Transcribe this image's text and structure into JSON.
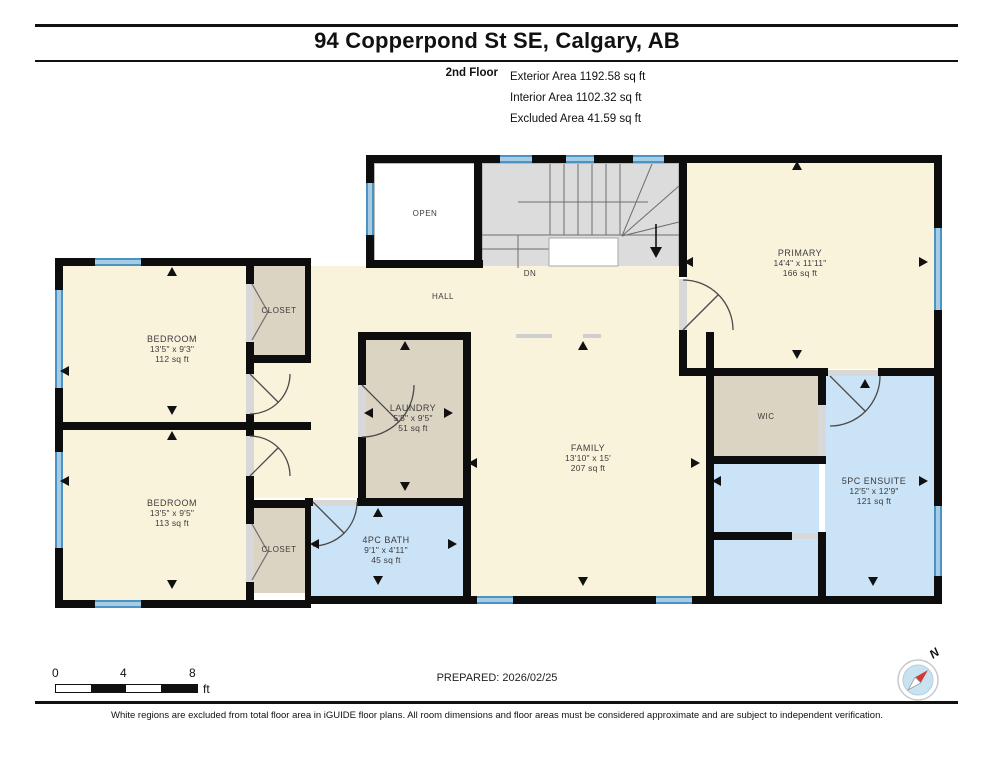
{
  "header": {
    "title": "94 Copperpond St SE, Calgary, AB",
    "floor_label": "2nd Floor",
    "stats": [
      "Exterior Area 1192.58 sq ft",
      "Interior Area 1102.32 sq ft",
      "Excluded Area 41.59 sq ft"
    ]
  },
  "plan": {
    "rooms": {
      "open": {
        "name": "OPEN"
      },
      "hall": {
        "name": "HALL"
      },
      "stairs": {
        "label": "DN"
      },
      "primary": {
        "name": "PRIMARY",
        "dims": "14'4\" x 11'11\"",
        "area": "166 sq ft"
      },
      "bedroom_top": {
        "name": "BEDROOM",
        "dims": "13'5\" x 9'3\"",
        "area": "112 sq ft"
      },
      "bedroom_bottom": {
        "name": "BEDROOM",
        "dims": "13'5\" x 9'5\"",
        "area": "113 sq ft"
      },
      "closet_top": {
        "name": "CLOSET"
      },
      "closet_bottom": {
        "name": "CLOSET"
      },
      "laundry": {
        "name": "LAUNDRY",
        "dims": "5'5\" x 9'5\"",
        "area": "51 sq ft"
      },
      "family": {
        "name": "FAMILY",
        "dims": "13'10\" x 15'",
        "area": "207 sq ft"
      },
      "wic": {
        "name": "WIC"
      },
      "bath": {
        "name": "4PC BATH",
        "dims": "9'1\" x 4'11\"",
        "area": "45 sq ft"
      },
      "ensuite": {
        "name": "5PC ENSUITE",
        "dims": "12'5\" x 12'9\"",
        "area": "121 sq ft"
      }
    }
  },
  "footer": {
    "prepared": "PREPARED: 2026/02/25",
    "scale": {
      "tick0": "0",
      "tick1": "4",
      "tick2": "8",
      "unit": "ft"
    },
    "compass_label": "N",
    "disclaimer": "White regions are excluded from total floor area in iGUIDE floor plans. All room dimensions and floor areas must be considered approximate and are subject to independent verification."
  },
  "colors": {
    "room_cream": "#FAF3DC",
    "room_tan": "#DBD4C2",
    "room_blue": "#CBE3F6",
    "stairs_gray": "#DCDCDC",
    "wall": "#0D0D0D",
    "window_blue": "#4A94C4",
    "compass_needle_red": "#D23B2F"
  }
}
